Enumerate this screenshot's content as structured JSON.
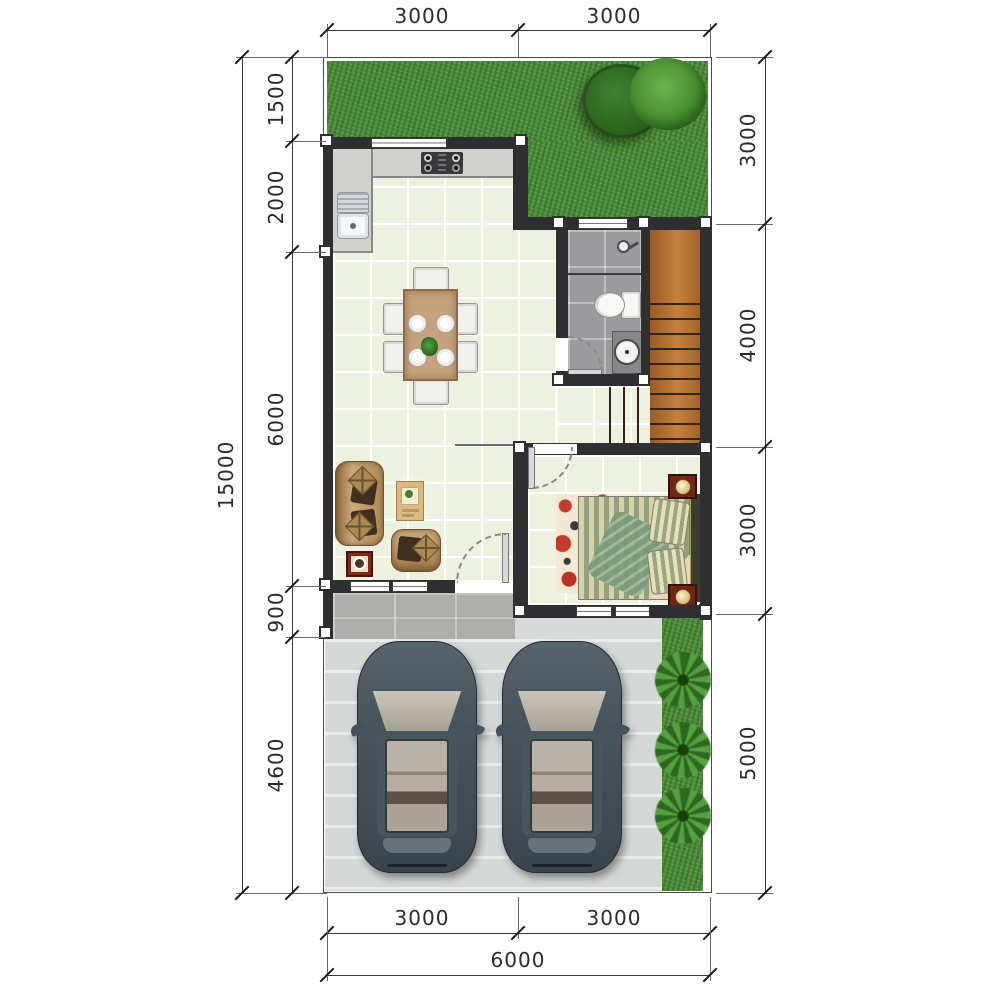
{
  "dimensions": {
    "top": [
      "3000",
      "3000"
    ],
    "left_outer": "15000",
    "left_inner": [
      "1500",
      "2000",
      "6000",
      "900",
      "4600"
    ],
    "right": [
      "3000",
      "4000",
      "3000",
      "5000"
    ],
    "bottom_inner": [
      "3000",
      "3000"
    ],
    "bottom_outer": "6000"
  },
  "colors": {
    "wall": "#2f2f31",
    "floor_tile": "#edf1df",
    "bath_floor": "#9b9b9e",
    "grass": "#4d8c3a",
    "stair_wood": "#b1703c",
    "driveway": "#d8dad9",
    "porch": "#adadab",
    "car_body": "#4b565e",
    "sofa": "#bf9c6a",
    "side_table": "#7c2a1a",
    "dimension_text": "#2b2b2b"
  }
}
